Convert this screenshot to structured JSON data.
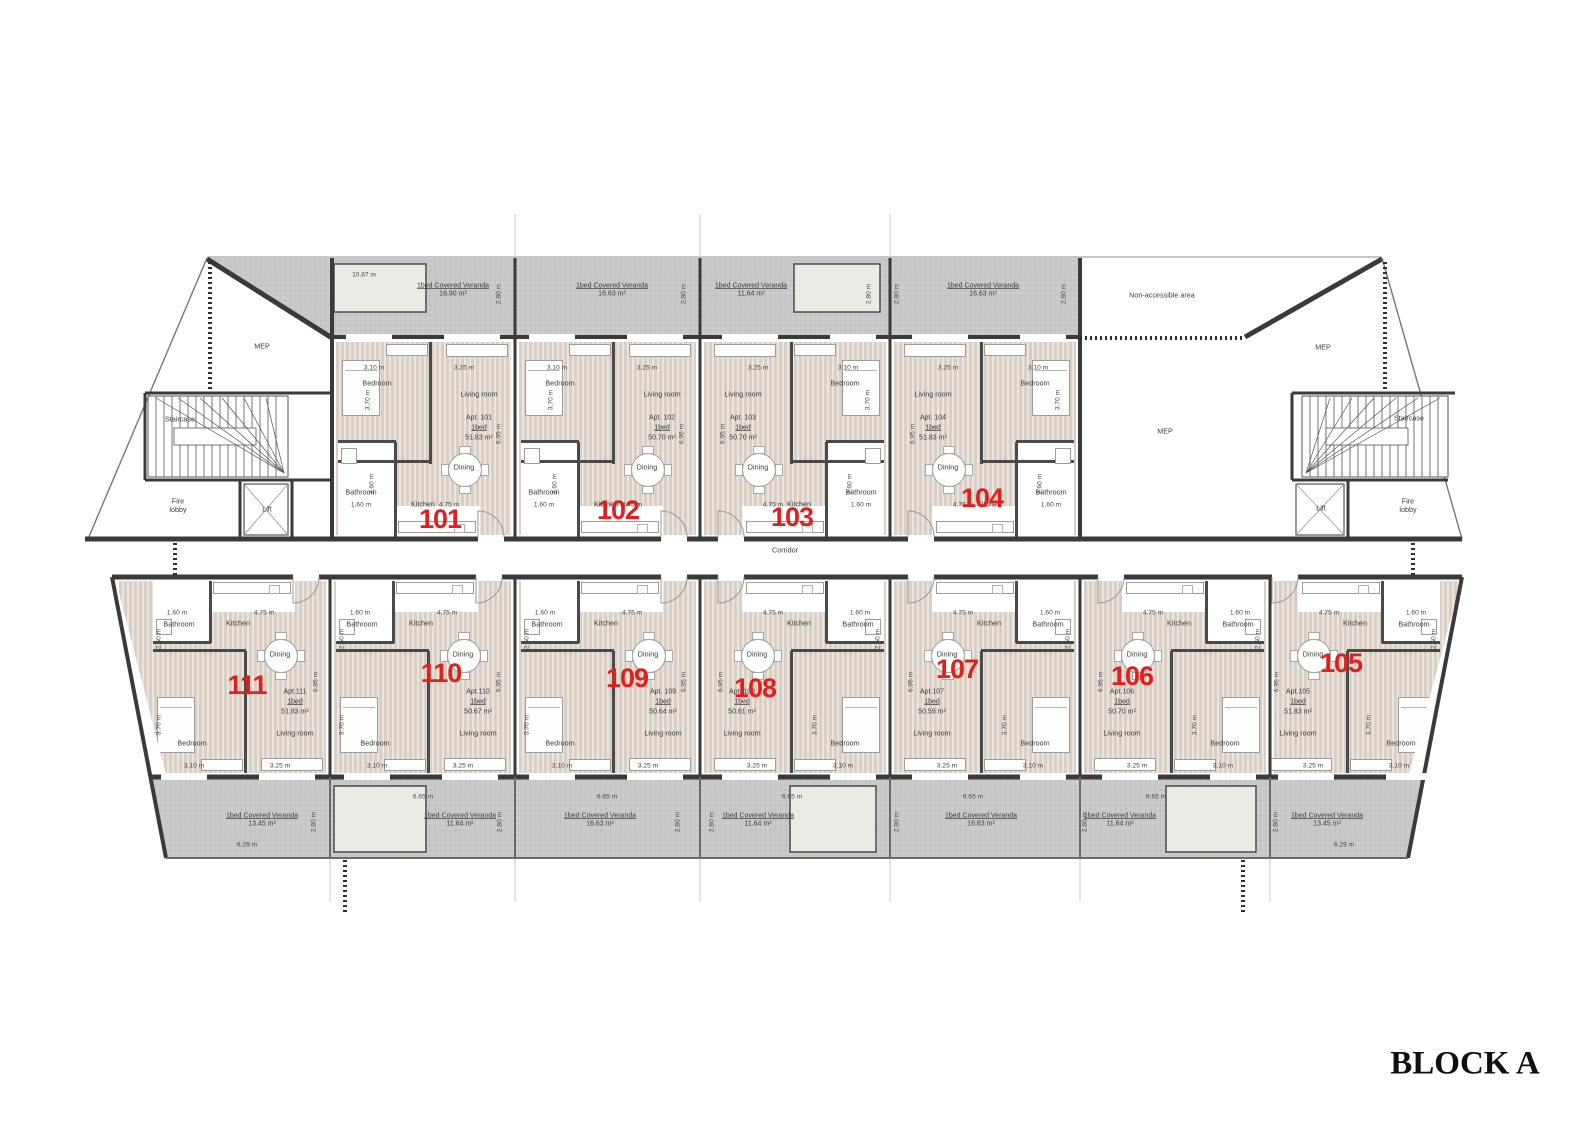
{
  "title": "BLOCK A",
  "labels": {
    "corridor": "Corridor",
    "non_accessible": "Non-accessible area",
    "mep": "MEP",
    "staircase": "Staircase",
    "fire_lobby": "Fire lobby",
    "lift": "Lift"
  },
  "rooms": {
    "bedroom": "Bedroom",
    "living": "Living room",
    "dining": "Dining",
    "kitchen": "Kitchen",
    "bathroom": "Bathroom"
  },
  "apartments": [
    {
      "number": "101",
      "name": "Apt. 101",
      "type": "1bed",
      "area": "51.83 m²",
      "dims": {
        "bedroom_w": "3.10 m",
        "bedroom_d": "3.70 m",
        "living_w": "3.25 m",
        "kitchen_w": "4.75 m",
        "bath_w": "1.60 m",
        "bath_d": "2.60 m",
        "depth": "6.95 m"
      }
    },
    {
      "number": "102",
      "name": "Apt. 102",
      "type": "1bed",
      "area": "50.70 m²",
      "dims": {
        "bedroom_w": "3.10 m",
        "bedroom_d": "3.70 m",
        "living_w": "3.25 m",
        "kitchen_w": "4.75 m",
        "bath_w": "1.60 m",
        "bath_d": "2.60 m",
        "depth": "6.95 m"
      }
    },
    {
      "number": "103",
      "name": "Apt. 103",
      "type": "1bed",
      "area": "50.70 m²",
      "dims": {
        "bedroom_w": "3.10 m",
        "bedroom_d": "3.70 m",
        "living_w": "3.25 m",
        "kitchen_w": "4.75 m",
        "bath_w": "1.60 m",
        "bath_d": "2.60 m",
        "depth": "6.95 m"
      }
    },
    {
      "number": "104",
      "name": "Apt. 104",
      "type": "1bed",
      "area": "51.83 m²",
      "dims": {
        "bedroom_w": "3.10 m",
        "bedroom_d": "3.70 m",
        "living_w": "3.25 m",
        "kitchen_w": "4.75 m",
        "bath_w": "1.60 m",
        "bath_d": "2.60 m",
        "depth": "6.95 m"
      }
    },
    {
      "number": "105",
      "name": "Apt.105",
      "type": "1bed",
      "area": "51.83 m²",
      "dims": {
        "bedroom_w": "3.10 m",
        "bedroom_d": "3.70 m",
        "living_w": "3.25 m",
        "kitchen_w": "4.75 m",
        "bath_w": "1.60 m",
        "bath_d": "2.60 m",
        "depth": "6.95 m"
      }
    },
    {
      "number": "106",
      "name": "Apt.106",
      "type": "1bed",
      "area": "50.70 m²",
      "dims": {
        "bedroom_w": "3.10 m",
        "bedroom_d": "3.70 m",
        "living_w": "3.25 m",
        "kitchen_w": "4.75 m",
        "bath_w": "1.60 m",
        "bath_d": "2.60 m",
        "depth": "6.95 m"
      }
    },
    {
      "number": "107",
      "name": "Apt.107",
      "type": "1bed",
      "area": "50.59 m²",
      "dims": {
        "bedroom_w": "3.10 m",
        "bedroom_d": "3.70 m",
        "living_w": "3.25 m",
        "kitchen_w": "4.75 m",
        "bath_w": "1.60 m",
        "bath_d": "2.60 m",
        "depth": "6.95 m"
      }
    },
    {
      "number": "108",
      "name": "Apt. 108",
      "type": "1bed",
      "area": "50.61 m²",
      "dims": {
        "bedroom_w": "3.10 m",
        "bedroom_d": "3.70 m",
        "living_w": "3.25 m",
        "kitchen_w": "4.75 m",
        "bath_w": "1.60 m",
        "bath_d": "2.60 m",
        "depth": "6.95 m"
      }
    },
    {
      "number": "109",
      "name": "Apt. 109",
      "type": "1bed",
      "area": "50.64 m²",
      "dims": {
        "bedroom_w": "3.10 m",
        "bedroom_d": "3.70 m",
        "living_w": "3.25 m",
        "kitchen_w": "4.75 m",
        "bath_w": "1.60 m",
        "bath_d": "2.60 m",
        "depth": "6.95 m"
      }
    },
    {
      "number": "110",
      "name": "Apt.110",
      "type": "1bed",
      "area": "50.67 m²",
      "dims": {
        "bedroom_w": "3.10 m",
        "bedroom_d": "3.70 m",
        "living_w": "3.25 m",
        "kitchen_w": "4.75 m",
        "bath_w": "1.60 m",
        "bath_d": "2.60 m",
        "depth": "6.95 m"
      }
    },
    {
      "number": "111",
      "name": "Apt.111",
      "type": "1bed",
      "area": "51.83 m²",
      "dims": {
        "bedroom_w": "3.10 m",
        "bedroom_d": "3.70 m",
        "living_w": "3.25 m",
        "kitchen_w": "4.75 m",
        "bath_w": "1.60 m",
        "bath_d": "2.60 m",
        "depth": "6.95 m"
      }
    }
  ],
  "verandas": {
    "label": "1bed Covered Veranda",
    "top": [
      {
        "area": "16.90 m²",
        "depth": "2.80 m",
        "pool_width": "10.87 m"
      },
      {
        "area": "16.63 m²",
        "depth": "2.80 m"
      },
      {
        "area": "11.64 m²",
        "depth": "2.80 m"
      },
      {
        "area": "16.63 m²",
        "depth": "2.80 m"
      }
    ],
    "bottom": [
      {
        "area": "13.45 m²",
        "depth": "2.80 m",
        "width": "6.29 m"
      },
      {
        "area": "11.64 m²",
        "depth": "2.80 m",
        "width": "6.65 m"
      },
      {
        "area": "16.63 m²",
        "depth": "2.80 m",
        "width": "6.65 m"
      },
      {
        "area": "11.64 m²",
        "depth": "2.80 m",
        "width": "6.65 m"
      },
      {
        "area": "16.63 m²",
        "depth": "2.80 m",
        "width": "6.65 m"
      },
      {
        "area": "11.64 m²",
        "depth": "2.80 m",
        "width": "6.65 m"
      },
      {
        "area": "13.45 m²",
        "depth": "2.80 m",
        "width": "6.29 m"
      }
    ]
  },
  "colors": {
    "apartment_number": "#e1201e",
    "wall": "#3a3a3a",
    "floor_stripe": "#d9cfc5",
    "veranda_fill": "#cbcbcb",
    "pool_fill": "#e8ece5"
  }
}
